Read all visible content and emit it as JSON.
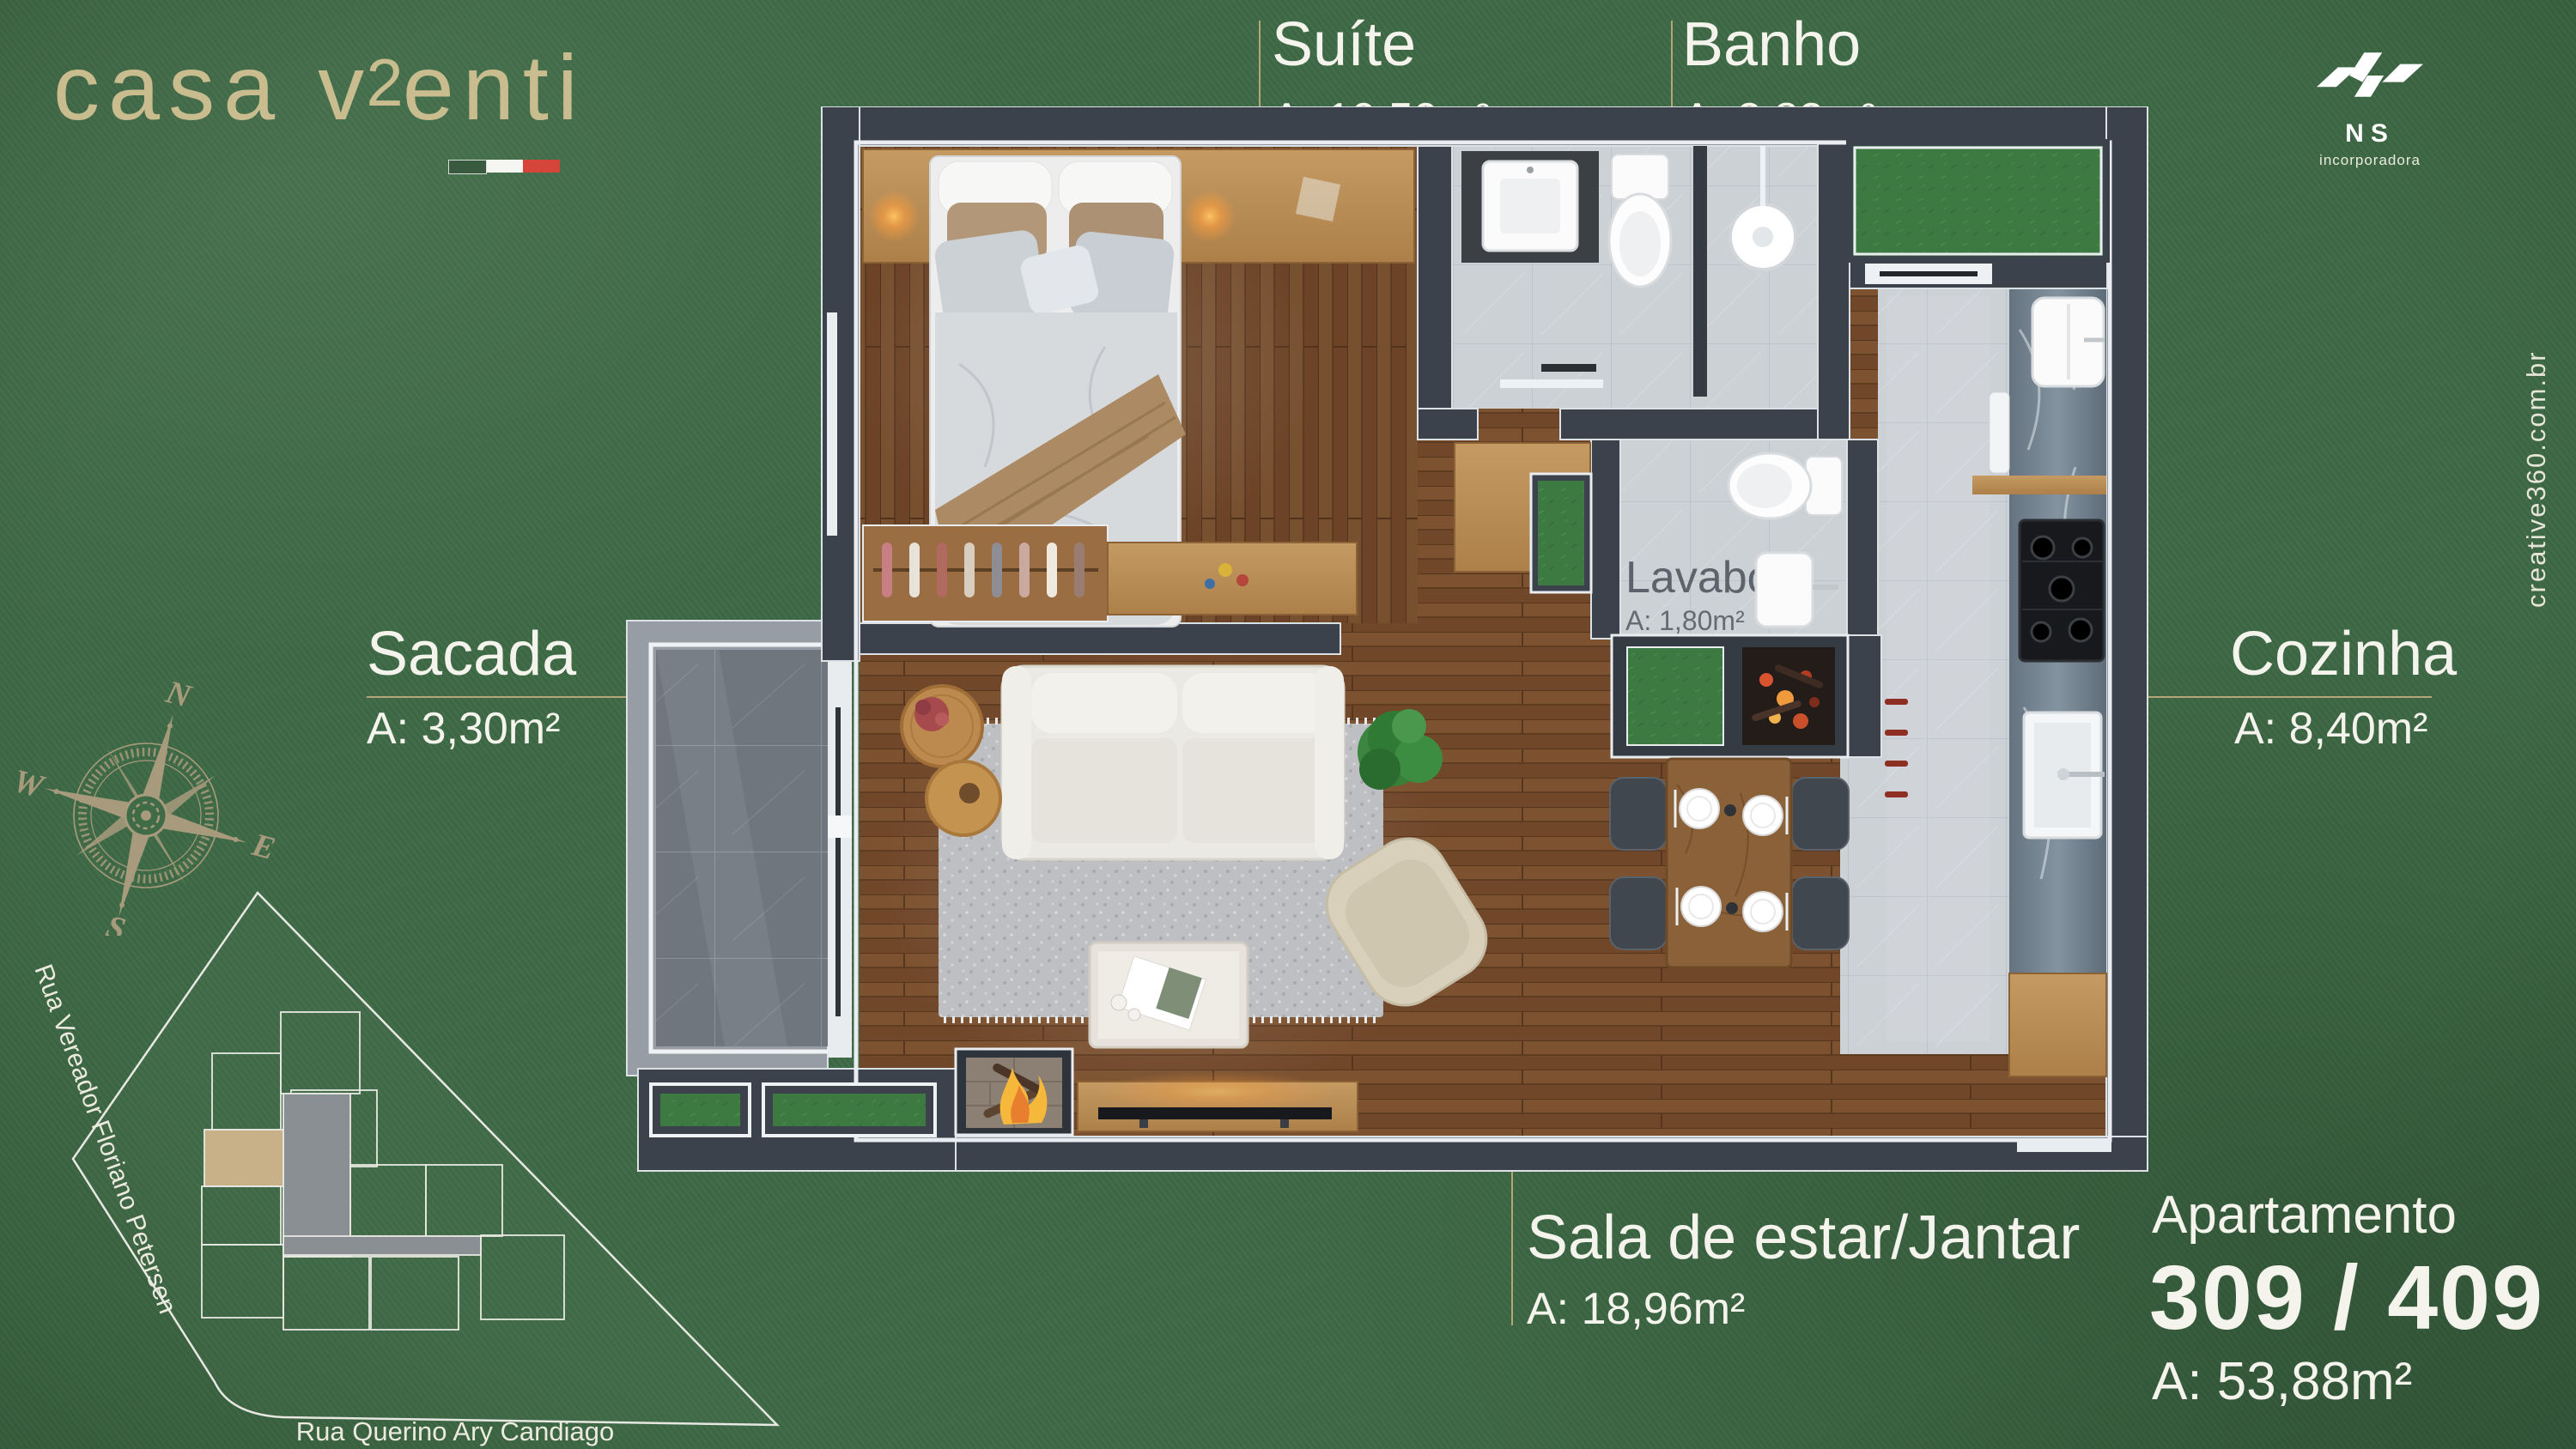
{
  "brand": {
    "logo_part1": "casa v",
    "logo_superscript": "2",
    "logo_part2": "enti",
    "color": "#c9bc8e",
    "flag_colors": [
      "#3a5a40",
      "#f5f6f1",
      "#d6453a"
    ]
  },
  "developer": {
    "name": "NS",
    "tagline": "incorporadora"
  },
  "credit": {
    "text": "creative360.com.br"
  },
  "apartment": {
    "label": "Apartamento",
    "numbers": "309 / 409",
    "area": "A: 53,88m²"
  },
  "rooms": [
    {
      "name": "Suíte",
      "area": "A: 10,50m²"
    },
    {
      "name": "Banho",
      "area": "A: 2,82m²"
    },
    {
      "name": "Lavabo",
      "area": "A: 1,80m²"
    },
    {
      "name": "Sacada",
      "area": "A: 3,30m²"
    },
    {
      "name": "Cozinha",
      "area": "A: 8,40m²"
    },
    {
      "name": "Sala de estar/Jantar",
      "area": "A: 18,96m²"
    }
  ],
  "compass": {
    "north": "N",
    "south": "S",
    "east": "E",
    "west": "W"
  },
  "site": {
    "street_left": "Rua Vereador Floriano Petersen",
    "street_bottom": "Rua Querino Ary Candiago",
    "highlight_color": "#c8b088"
  },
  "accents": {
    "background_green": "#3f6b46",
    "leader_line": "#b5a578",
    "label_text": "#f4f3ec",
    "wall": "#3b424b"
  }
}
